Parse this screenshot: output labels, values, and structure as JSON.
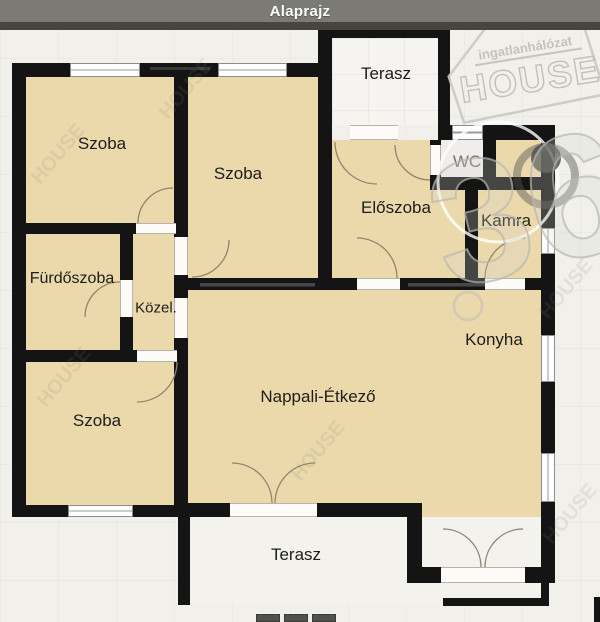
{
  "header": {
    "title": "Alaprajz"
  },
  "rooms": {
    "szoba_top_left": {
      "label": "Szoba"
    },
    "szoba_top_mid": {
      "label": "Szoba"
    },
    "terasz_top": {
      "label": "Terasz"
    },
    "eloszoba": {
      "label": "Előszoba"
    },
    "wc": {
      "label": "WC"
    },
    "kamra": {
      "label": "Kamra"
    },
    "furdoszoba": {
      "label": "Fürdőszoba"
    },
    "kozlekedo": {
      "label": "Közel."
    },
    "konyha": {
      "label": "Konyha"
    },
    "szoba_bottom_left": {
      "label": "Szoba"
    },
    "nappali_etkezo": {
      "label": "Nappali-Étkező"
    },
    "terasz_bottom": {
      "label": "Terasz"
    }
  },
  "watermark": {
    "brand_line": "ingatlanhálózat",
    "brand_name": "HOUSE",
    "badge_number": "36"
  },
  "colors": {
    "wall": "#141414",
    "room_fill": "#ecd9ab",
    "terrace_fill": "#f5f4f0",
    "background": "#f1f0eb",
    "header_bar": "#7b7a75",
    "header_strip": "#46453f",
    "step": "#51514f",
    "watermark_gray": "#c6c5c0"
  }
}
